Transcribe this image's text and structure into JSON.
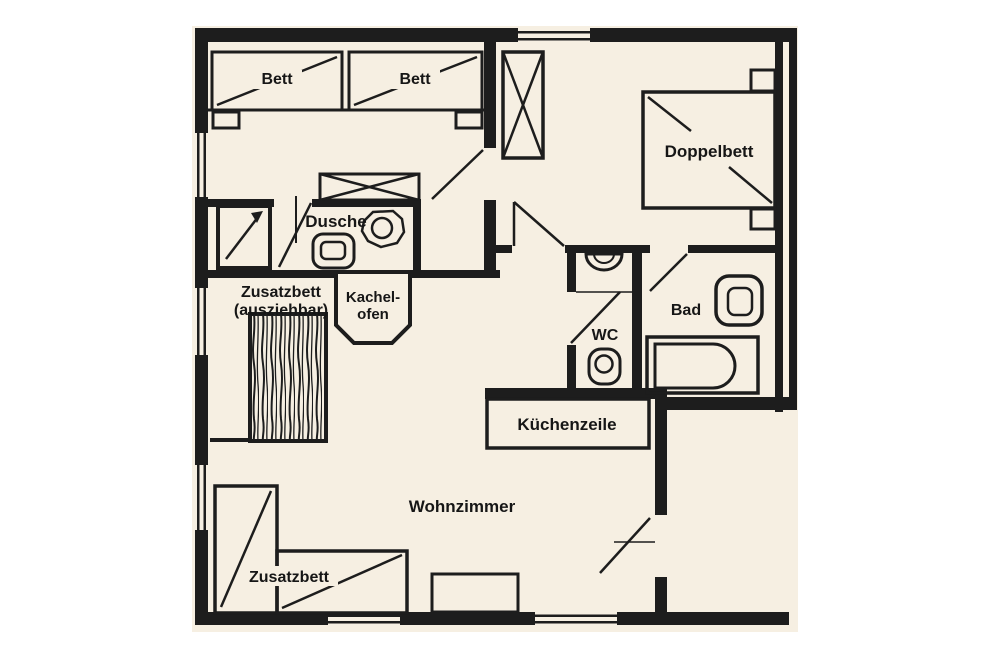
{
  "floorplan": {
    "labels": {
      "bett1": "Bett",
      "bett2": "Bett",
      "doppelbett": "Doppelbett",
      "dusche": "Dusche",
      "zusatzbett_line1": "Zusatzbett",
      "zusatzbett_line2": "(ausziehbar)",
      "kachelofen_line1": "Kachel-",
      "kachelofen_line2": "ofen",
      "wc": "WC",
      "bad": "Bad",
      "kuechenzeile": "Küchenzeile",
      "wohnzimmer": "Wohnzimmer",
      "zusatzbett_sofa": "Zusatzbett"
    },
    "colors": {
      "page": "#ffffff",
      "floor": "#f6efe2",
      "wall": "#1d1d1d",
      "text": "#161616"
    }
  }
}
